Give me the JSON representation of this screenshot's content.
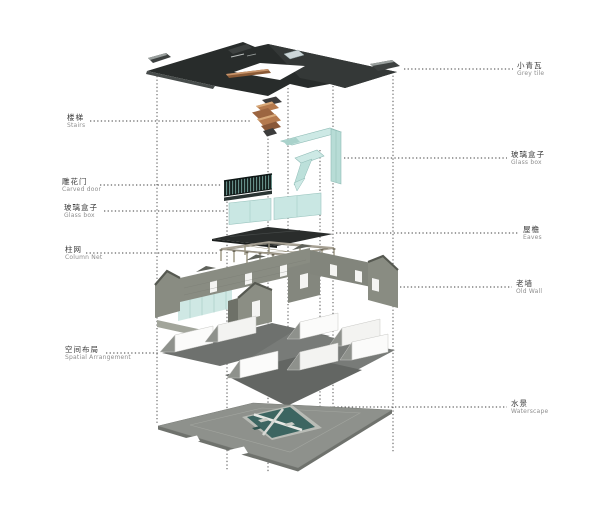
{
  "figure": {
    "type": "exploded axonometric building diagram",
    "language": "zh-en bilingual callouts"
  },
  "labels": {
    "left": [
      {
        "zh": "楼梯",
        "en": "Stairs"
      },
      {
        "zh": "雕花门",
        "en": "Carved door"
      },
      {
        "zh": "玻璃盒子",
        "en": "Glass box"
      },
      {
        "zh": "柱网",
        "en": "Column Net"
      },
      {
        "zh": "空间布局",
        "en": "Spatial Arrangement"
      }
    ],
    "right": [
      {
        "zh": "小青瓦",
        "en": "Grey tile"
      },
      {
        "zh": "玻璃盒子",
        "en": "Glass box"
      },
      {
        "zh": "屋檐",
        "en": "Eaves"
      },
      {
        "zh": "老墙",
        "en": "Old Wall"
      },
      {
        "zh": "水景",
        "en": "Waterscape"
      }
    ]
  },
  "colors": {
    "roof": "#282c2b",
    "glass": "#cde9e5",
    "stairs": "#b57a4e",
    "wall": "#898c82",
    "floor": "#6e716e",
    "plate": "#8e918c",
    "water": "#3c6561",
    "leader": "#3f3f3f"
  }
}
